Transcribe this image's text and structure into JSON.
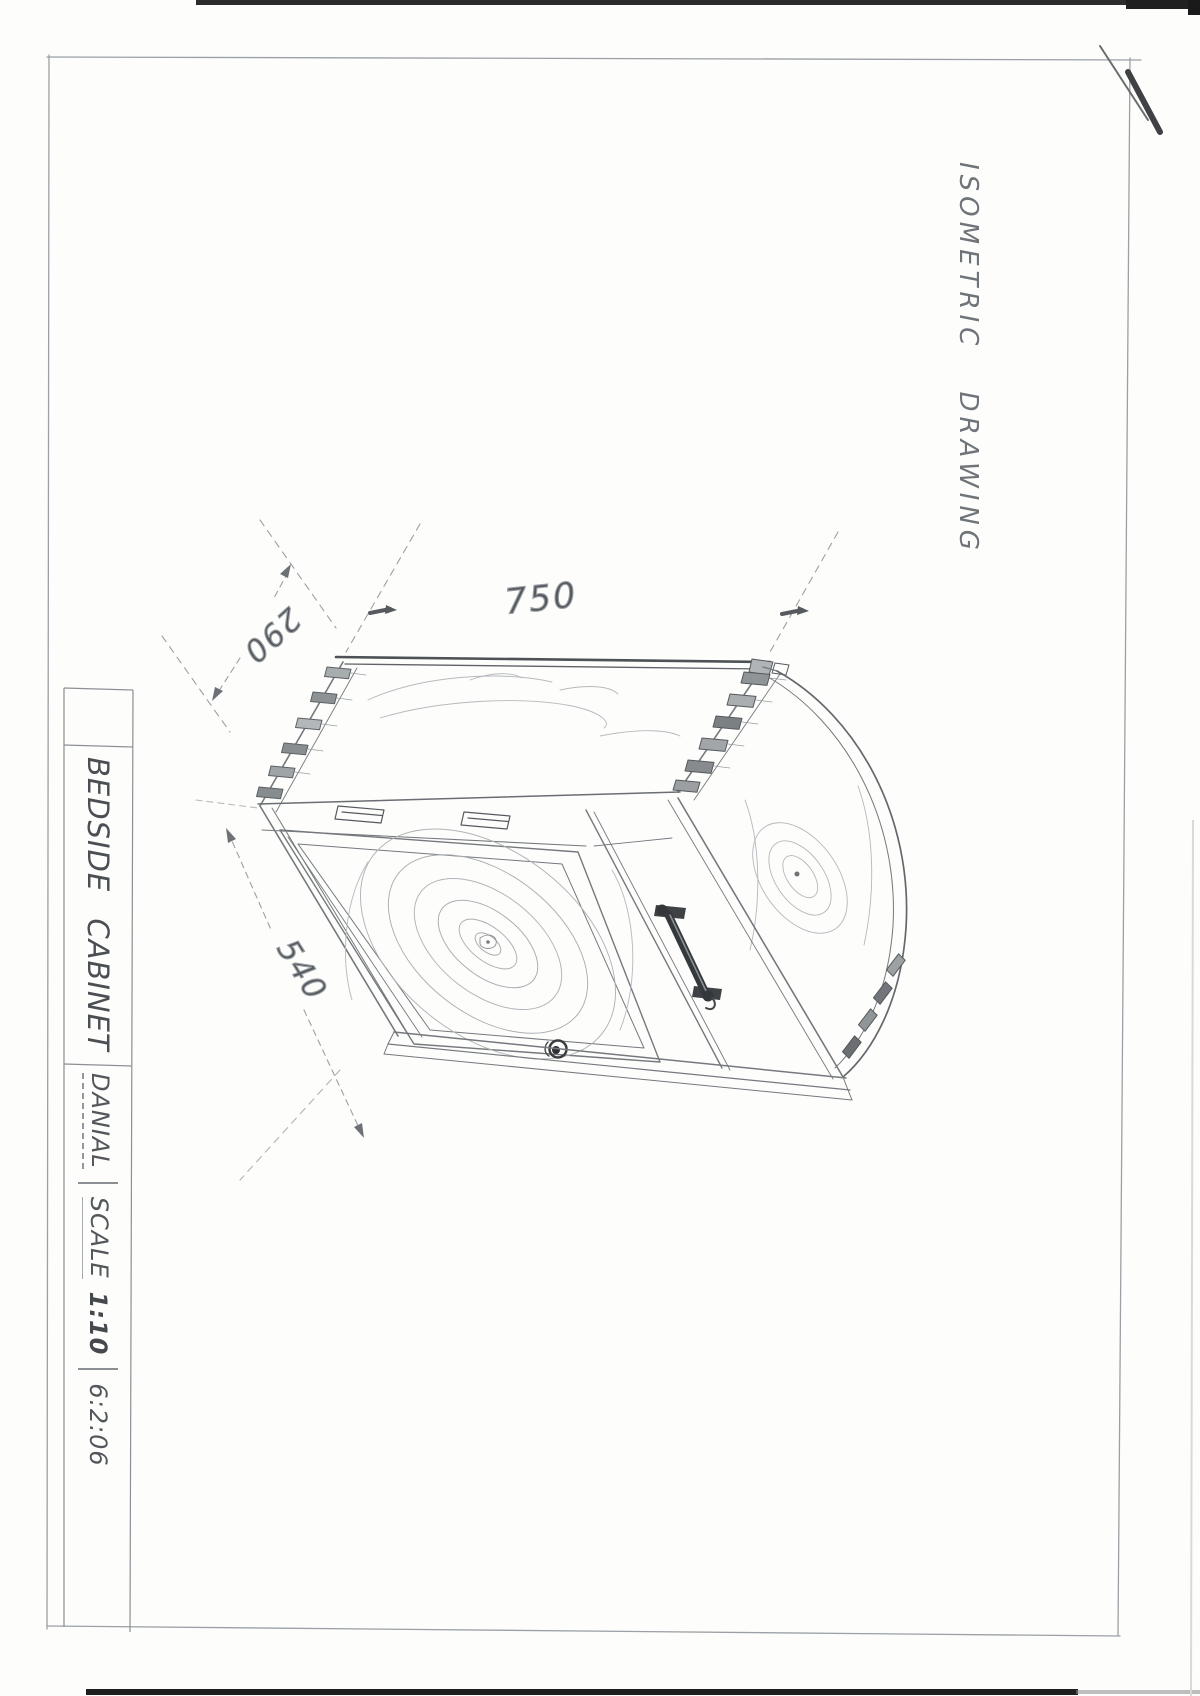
{
  "sheet": {
    "side_label": "ISOMETRIC DRAWING",
    "dimensions": {
      "width_mm": "750",
      "depth_mm": "290",
      "height_mm": "540"
    },
    "title_block": {
      "title": "BEDSIDE CABINET",
      "author": "DANIAL",
      "scale_word": "SCALE",
      "scale_value": "1:10",
      "date": "6:2:06"
    }
  }
}
